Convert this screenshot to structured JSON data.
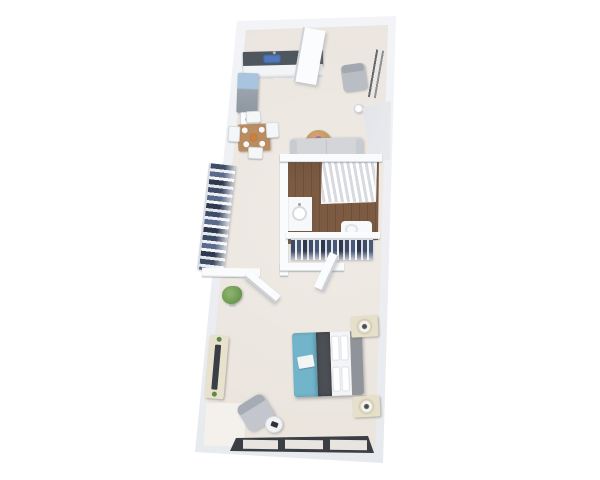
{
  "scene": {
    "type": "3D rendered apartment floor plan, top-down view on white background",
    "rooms": {
      "kitchen": {
        "label": "Kitchen",
        "items": [
          "dark countertop",
          "blue sink",
          "refrigerator",
          "stove"
        ]
      },
      "entry": {
        "label": "Entry",
        "items": [
          "open entry door",
          "gray armchair",
          "leaning mirror",
          "small vase"
        ]
      },
      "dining": {
        "label": "Dining Area",
        "items": [
          "wood table",
          "4 white chairs",
          "4 place settings",
          "fruit bowl"
        ]
      },
      "living": {
        "label": "Living Area",
        "items": [
          "gray sofa",
          "round wood coffee table",
          "purple flowers"
        ]
      },
      "hall_closet": {
        "label": "Hall Closet",
        "items": [
          "hanging clothes"
        ]
      },
      "bathroom": {
        "label": "Bathroom",
        "items": [
          "bathtub with shower curtain",
          "vanity with round sink",
          "toilet",
          "wood plank floor"
        ]
      },
      "walk_in_closet": {
        "label": "Walk-in Closet",
        "items": [
          "hanging clothes",
          "open closet door"
        ]
      },
      "bedroom": {
        "label": "Bedroom",
        "items": [
          "bed with teal duvet",
          "2 nightstands with lamps",
          "dresser with TV",
          "gray accent chair",
          "round side table",
          "potted plant",
          "rug",
          "triple-pane window"
        ]
      }
    },
    "palette": {
      "background": "#ffffff",
      "wall": "#f4f5f8",
      "wall_shadow": "#9aa1ab",
      "floor": "#eae4dd",
      "bathroom_wood": "#7c5b42",
      "counter_dark": "#50565e",
      "sink_blue": "#4f79b7",
      "fridge_top_blue": "#a9c4de",
      "sofa_gray": "#d3d5d9",
      "bed_teal": "#72b4c9",
      "bed_runner_gray": "#4b4e54",
      "headboard_gray": "#90949a",
      "nightstand_cream": "#e6dfc9",
      "table_wood": "#b98d5f",
      "coffee_table_wood": "#c59a66",
      "flower_purple": "#b16bb5",
      "clothes_navy": "#3f4c68",
      "plant_green": "#6e9b54",
      "window_frame_dark": "#3b3e44"
    }
  }
}
